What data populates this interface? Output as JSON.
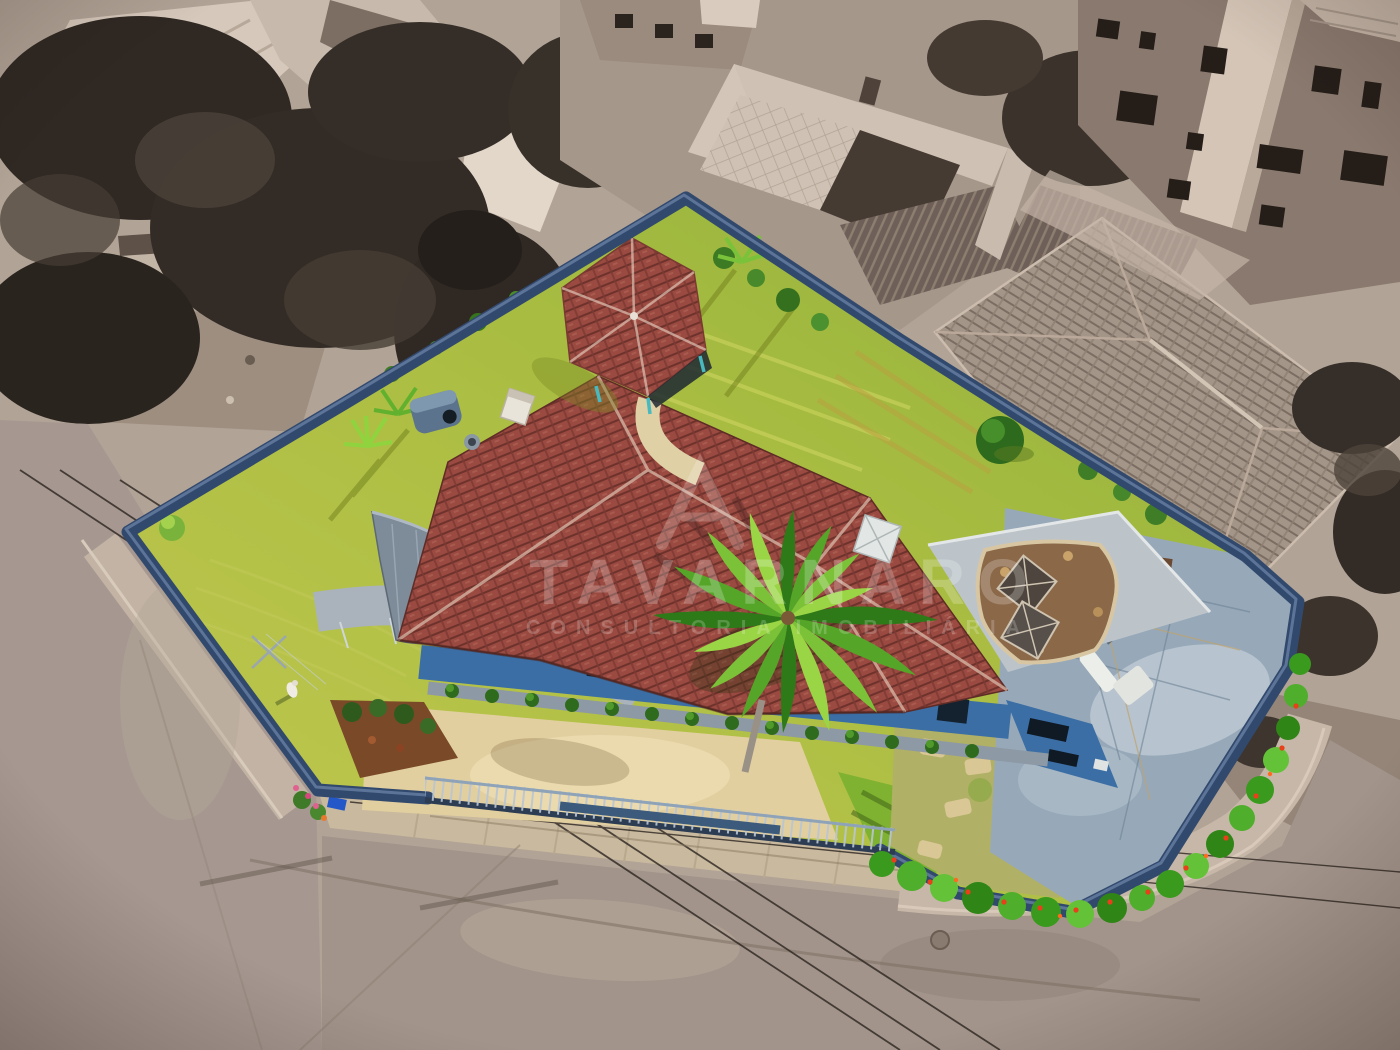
{
  "watermark": {
    "brand": "TAVARNARO",
    "tagline": "CONSULTORIA IMOBILIÁRIA",
    "logo": "triangle-peak-logo"
  },
  "palette": {
    "perimeter_wall_blue": "#32496e",
    "house_facade_blue": "#3b6ea5",
    "roof_tile_red": "#9a4a40",
    "gazebo_roof_red": "#9a4a40",
    "lawn_yellow_green": "#b9c24a",
    "lawn_bright_green": "#7fb231",
    "patio_slate": "#97a9b9",
    "terrace_light_gray": "#bcc4ca",
    "gravel_brown": "#8a6848",
    "driveway_beige": "#e2cf9f",
    "hedge_green": "#43a024",
    "flower_orange_red": "#e8401a",
    "street_sepia": "#a2948a",
    "sidewalk_sepia": "#c6b7a8",
    "monochrome_trees": "#2f2823",
    "monochrome_roof_light": "#d6c9bc",
    "monochrome_roof_gray": "#a39588",
    "monochrome_wall": "#8a796e"
  }
}
